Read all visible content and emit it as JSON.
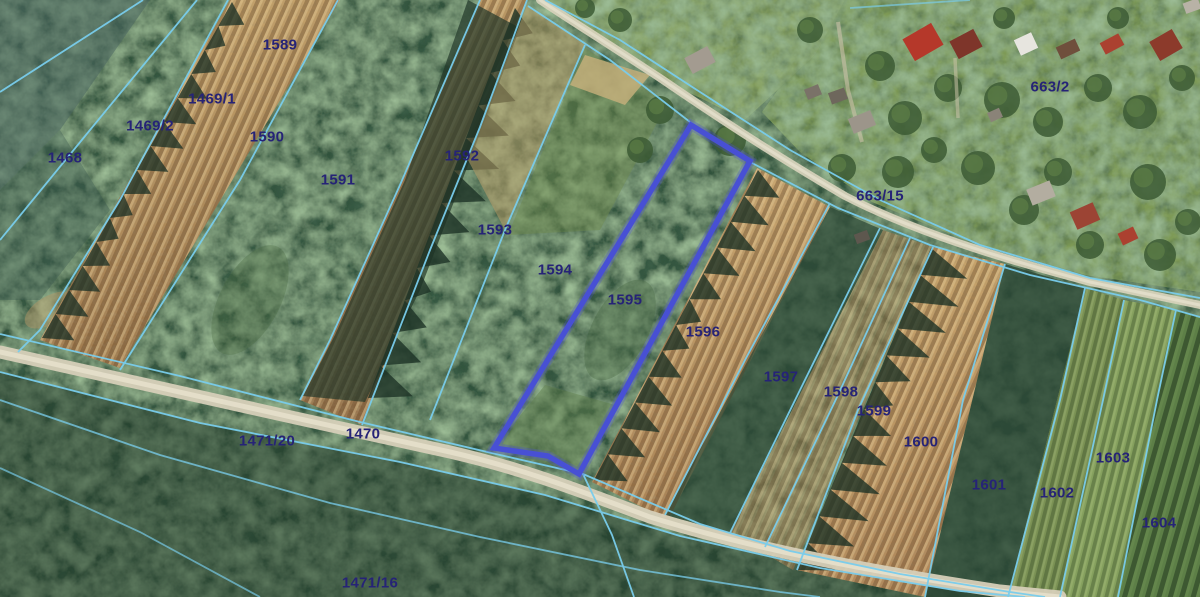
{
  "map": {
    "description": "cadastral-parcel-overlay-on-aerial-imagery",
    "highlighted_parcel": "1595",
    "colors": {
      "parcel_boundary": "#79cdec",
      "highlight_outline": "#4850d4",
      "parcel_label": "#262377"
    },
    "parcels": [
      {
        "id": "1589",
        "x": 280,
        "y": 45
      },
      {
        "id": "1469/1",
        "x": 212,
        "y": 99
      },
      {
        "id": "1469/2",
        "x": 150,
        "y": 126
      },
      {
        "id": "1468",
        "x": 65,
        "y": 158
      },
      {
        "id": "1590",
        "x": 267,
        "y": 137
      },
      {
        "id": "1591",
        "x": 338,
        "y": 180
      },
      {
        "id": "1592",
        "x": 462,
        "y": 156
      },
      {
        "id": "1593",
        "x": 495,
        "y": 230
      },
      {
        "id": "1594",
        "x": 555,
        "y": 270
      },
      {
        "id": "1595",
        "x": 625,
        "y": 300
      },
      {
        "id": "1596",
        "x": 703,
        "y": 332
      },
      {
        "id": "1597",
        "x": 781,
        "y": 377
      },
      {
        "id": "1598",
        "x": 841,
        "y": 392
      },
      {
        "id": "1599",
        "x": 874,
        "y": 411
      },
      {
        "id": "1600",
        "x": 921,
        "y": 442
      },
      {
        "id": "1601",
        "x": 989,
        "y": 485
      },
      {
        "id": "1602",
        "x": 1057,
        "y": 493
      },
      {
        "id": "1603",
        "x": 1113,
        "y": 458
      },
      {
        "id": "1604",
        "x": 1159,
        "y": 523
      },
      {
        "id": "663/2",
        "x": 1050,
        "y": 87
      },
      {
        "id": "663/15",
        "x": 880,
        "y": 196
      },
      {
        "id": "1470",
        "x": 363,
        "y": 434
      },
      {
        "id": "1471/20",
        "x": 267,
        "y": 441
      },
      {
        "id": "1471/16",
        "x": 370,
        "y": 583
      }
    ]
  }
}
